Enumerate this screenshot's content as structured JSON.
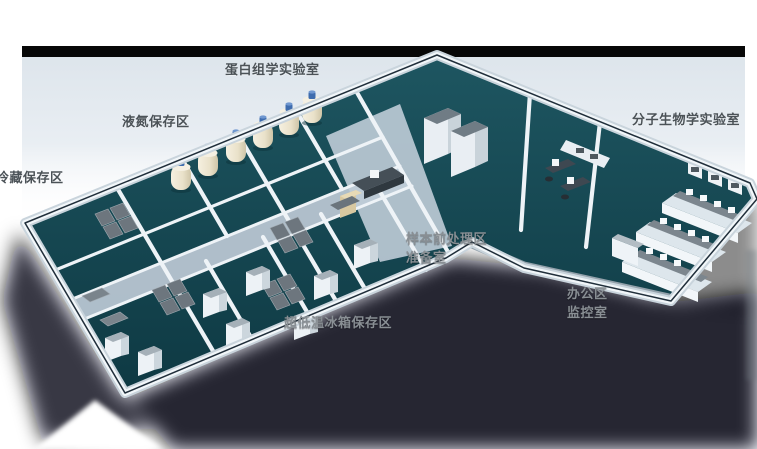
{
  "figure": {
    "kind": "isometric-3d-lab-floorplan-render",
    "background_color": "#ffffff",
    "top_bar_color": "#070707",
    "backdrop_tint": "#dce4eb"
  },
  "labels": [
    {
      "id": "proteomics-lab",
      "text": "蛋白组学实验室",
      "tone": "dark"
    },
    {
      "id": "liquid-nitrogen-storage",
      "text": "液氮保存区",
      "tone": "dark"
    },
    {
      "id": "cold-storage",
      "text": "冷藏保存区",
      "tone": "dark"
    },
    {
      "id": "molecular-biology-lab",
      "text": "分子生物学实验室",
      "tone": "dark"
    },
    {
      "id": "sample-pretreatment-area",
      "text": "样本前处理区",
      "tone": "light"
    },
    {
      "id": "preparation-room",
      "text": "准备室",
      "tone": "light"
    },
    {
      "id": "office-area",
      "text": "办公区",
      "tone": "light"
    },
    {
      "id": "monitoring-room",
      "text": "监控室",
      "tone": "light"
    },
    {
      "id": "ultralow-freezer-storage",
      "text": "超低温冰箱保存区",
      "tone": "light"
    }
  ],
  "palette": {
    "floor_teal": "#15434d",
    "corridor_light": "#b7c5d1",
    "wall_white": "#f1f6f9",
    "wall_shade": "#c9d4dc",
    "parapet_rim": "#202e3a",
    "front_wall_gray": "#93a1ab",
    "tank_body": "#ece4cf",
    "tank_cap": "#3e6cae",
    "freezer_top_gray": "#6d767e",
    "desk_dark": "#3e4851",
    "bench_white": "#e8eef3",
    "shadow": "#04070a",
    "label_dark": "#4b5257",
    "label_light": "#898f94"
  }
}
